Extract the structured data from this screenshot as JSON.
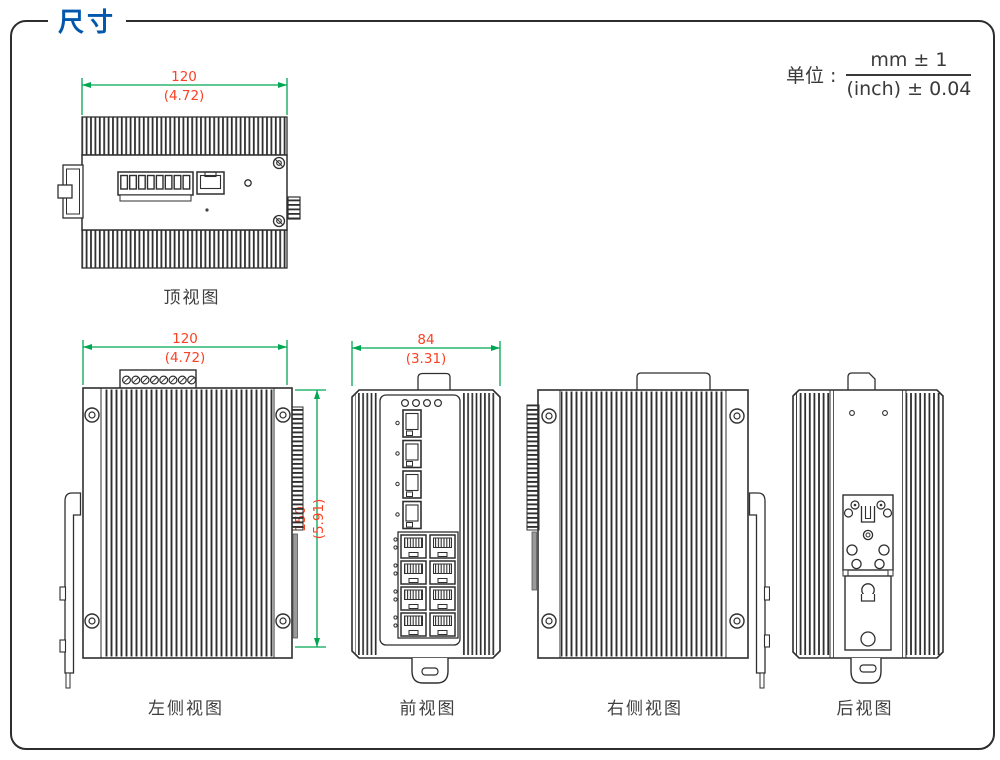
{
  "page": {
    "title": "尺寸"
  },
  "colors": {
    "accent_blue": "#0057AC",
    "dimension_text_red": "#FA4224",
    "dimension_line_green": "#00A651",
    "line_art": "#2F2F2F"
  },
  "unit": {
    "label": "单位 :",
    "mm_tolerance": "mm ± 1",
    "inch_tolerance": "(inch) ± 0.04"
  },
  "views": {
    "top": {
      "label": "顶视图",
      "width_mm": "120",
      "width_in": "(4.72)"
    },
    "left": {
      "label": "左侧视图",
      "width_mm": "120",
      "width_in": "(4.72)",
      "height_mm": "150",
      "height_in": "(5.91)"
    },
    "front": {
      "label": "前视图",
      "width_mm": "84",
      "width_in": "(3.31)"
    },
    "right": {
      "label": "右侧视图"
    },
    "rear": {
      "label": "后视图"
    }
  }
}
